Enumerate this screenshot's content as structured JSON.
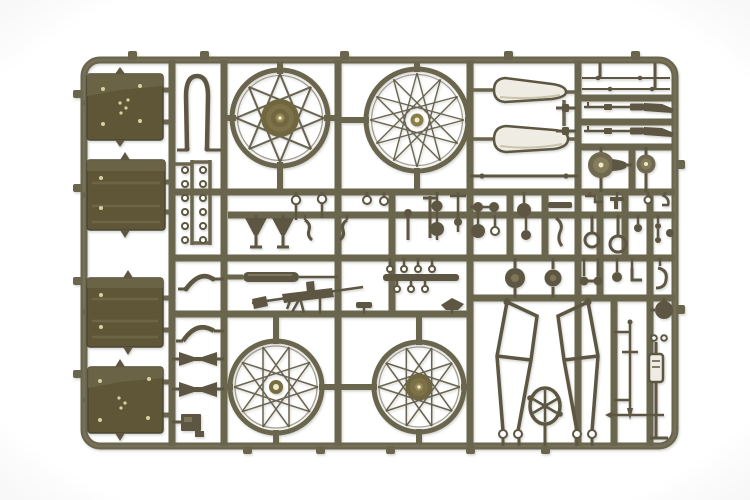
{
  "scene": {
    "type": "product-photo",
    "subject": "Olive drab plastic model kit sprue (parts tree) for a WWII military motorcycle with sidecar: four wire-spoked wheels, four pannier cases, two fenders, front fork, frame halves, rifles, machine gun, muffler and many small fittings, photographed on a white background",
    "background": "plain white, no visible text"
  },
  "palette": {
    "background": "#ffffff",
    "plastic": "#6b654e",
    "plastic_dark": "#5d5742",
    "plastic_edge": "#4c4736",
    "spoke": "#5b5540",
    "box": "#5e5637",
    "box_light": "#6d6546",
    "rivet": "#d9d0a2",
    "hub": "#6f663f",
    "hub_mid": "#7b7148",
    "hub_highlight": "#efe9c8",
    "shell": "#efede3"
  },
  "parts_inventory": {
    "spoked_wheels": 4,
    "pannier_cases": 4,
    "fenders": 2,
    "front_fork": 1,
    "rifles": 2,
    "machine_gun": 1,
    "muffler": 1,
    "frame_halves": 2,
    "spoked_hub_fan": 1,
    "brake_drum_pulleys": 2,
    "shock_absorber": 1,
    "eyelet_rings": 14,
    "small_fittings": "numerous levers, discs, rods and brackets"
  }
}
